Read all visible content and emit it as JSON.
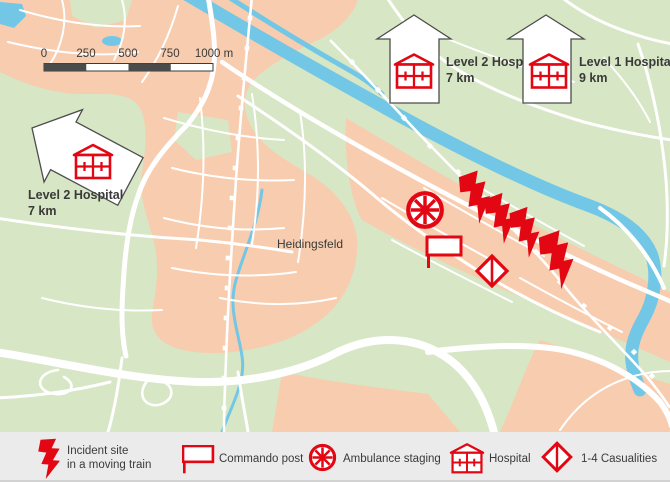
{
  "map": {
    "town_label": "Heidingsfeld",
    "scale_bar": {
      "tick0": "0",
      "tick1": "250",
      "tick2": "500",
      "tick3": "750",
      "tick4": "1000 m"
    },
    "hospital_arrows": {
      "up_level2": {
        "name": "Level 2 Hospital",
        "distance": "7 km"
      },
      "up_level1": {
        "name": "Level 1 Hospital",
        "distance": "9 km"
      },
      "left_level2": {
        "name": "Level 2 Hospital",
        "distance": "7 km"
      }
    }
  },
  "legend": {
    "incident_line1": "Incident site",
    "incident_line2": "in a moving train",
    "commando_post": "Commando post",
    "ambulance_staging": "Ambulance staging",
    "hospital": "Hospital",
    "casualties": "1-4 Casualities"
  },
  "colors": {
    "signal_red": "#e30613",
    "urban_area": "#f8ccae",
    "parkland": "#d7e6c4",
    "water": "#72c7e7",
    "legend_background": "#ebebeb",
    "text": "#3a3a3a",
    "arrow_outline": "#4d4d4d"
  }
}
